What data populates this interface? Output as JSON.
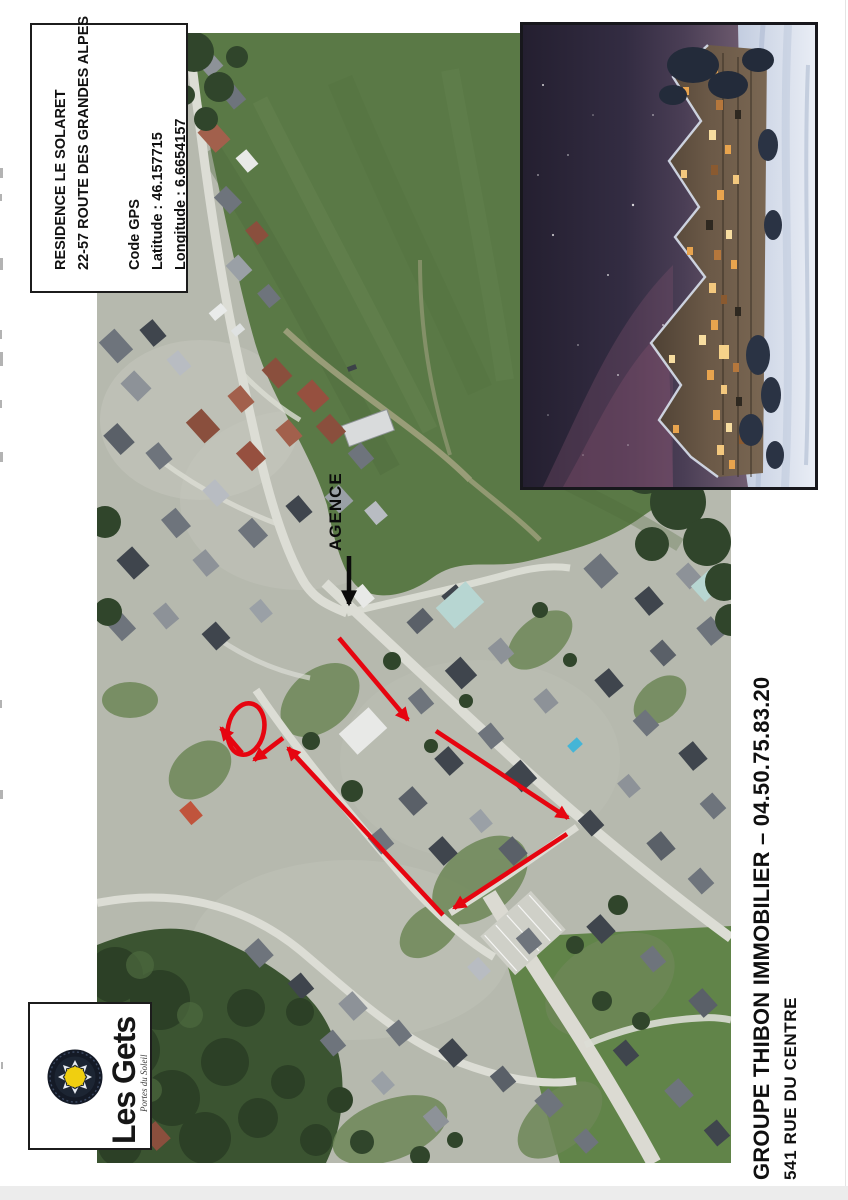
{
  "info_box": {
    "residence": "RESIDENCE LE SOLARET",
    "address": "22-57 ROUTE DES GRANDES ALPES",
    "gps_heading": "Code GPS",
    "latitude": "Latitude : 46.157715",
    "longitude": "Longitude : 6.6654157"
  },
  "map": {
    "agence_label": "AGENCE"
  },
  "logo": {
    "brand": "Les Gets",
    "tagline": "Portes du Soleil"
  },
  "footer": {
    "company": "GROUPE THIBON IMMOBILIER – 04.50.75.83.20",
    "address": "541 RUE DU CENTRE"
  },
  "colors": {
    "annotation_red": "#e60510",
    "arrow_black": "#0b0b0b",
    "meadow_green": "#5a7946",
    "forest_green": "#3b5431",
    "night_sky": "#241f30",
    "snow": "#dde4f0",
    "chalet_wood": "#6b5947",
    "window_glow": "#e8a44e"
  }
}
